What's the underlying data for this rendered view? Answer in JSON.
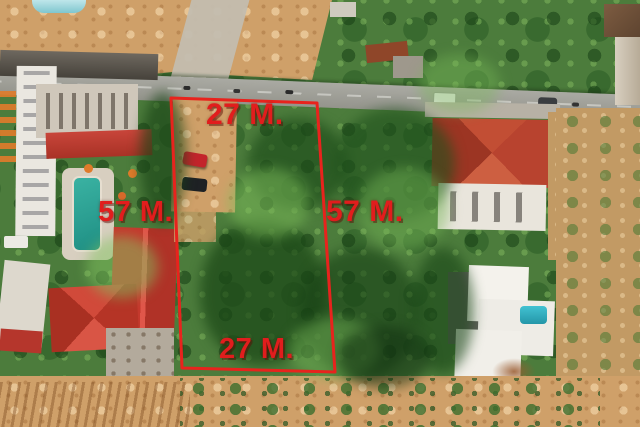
{
  "annotations": {
    "top_label": "27 M.",
    "bottom_label": "27 M.",
    "left_label": "57 M.",
    "right_label": "57 M.",
    "boundary_color": "#e8231d",
    "label_color": "#e11d1d"
  },
  "scene": {
    "colors": {
      "vegetation": "#4c7c3c",
      "sand": "#cfa069",
      "road": "#a0a099",
      "red_roof": "#c0392b",
      "bright_red_roof": "#d6453a",
      "hotel_pool": "#2aa796",
      "villa_pool": "#34b4c6",
      "white_building": "#eceae3"
    }
  }
}
